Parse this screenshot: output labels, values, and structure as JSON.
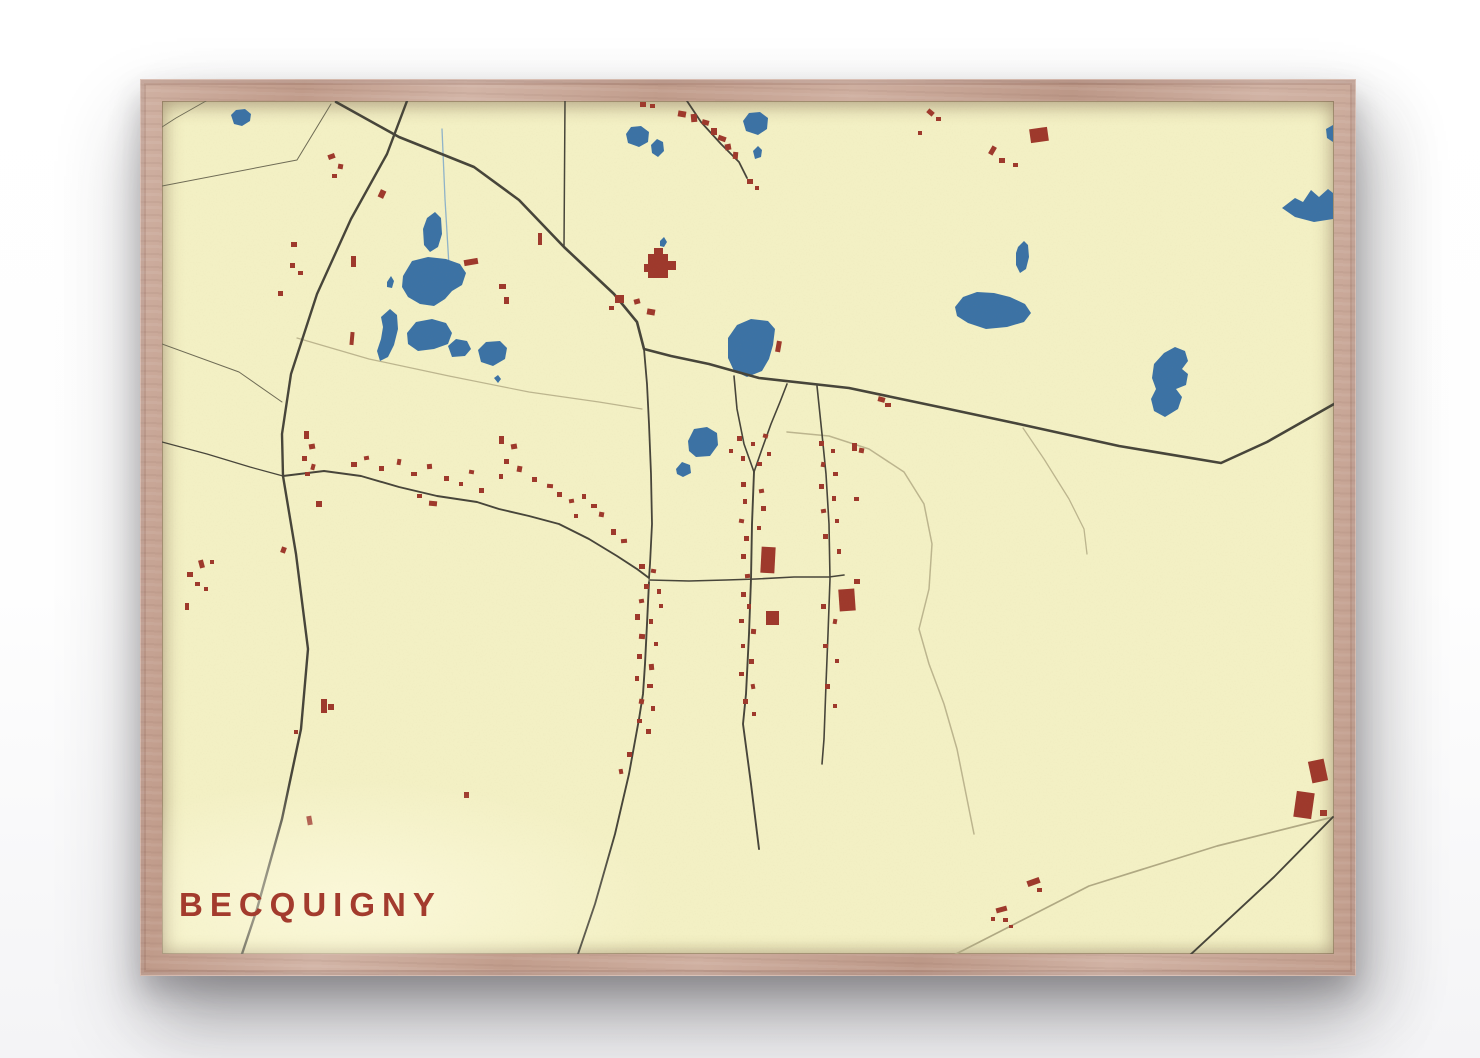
{
  "poster": {
    "title": "BECQUIGNY",
    "title_color": "#a33b2d"
  },
  "frame": {
    "wood_color": "#c8a493"
  },
  "map": {
    "width": 1172,
    "height": 853,
    "colors": {
      "bg": "#f3f0c4",
      "water": "#3c72a4",
      "building": "#9e392c",
      "road": "#47453a",
      "thin": "#6e6b55",
      "trail": "#bcb58e",
      "track": "#b0a983",
      "stream": "#8fb3c9"
    },
    "trails": [
      {
        "n": "village-loop-trail",
        "c": "trail",
        "w": 1.5,
        "p": "625,331 667,335 707,348 742,371 762,403 770,443 767,488 757,528 767,563 782,603 795,648 805,698 812,733"
      },
      {
        "n": "field-track",
        "c": "trail",
        "w": 1.3,
        "p": "861,327 882,358 907,398 922,428 925,453"
      },
      {
        "n": "field-boundary",
        "c": "trail",
        "w": 1.2,
        "p": "135,237 207,258 287,275 367,291 437,301 480,308"
      },
      {
        "n": "southeast-track",
        "c": "track",
        "w": 1.7,
        "p": "1171,716 1055,745 927,785 790,855"
      },
      {
        "n": "stream",
        "c": "stream",
        "w": 1.3,
        "p": "280,28 283,98 287,165"
      }
    ],
    "roads": [
      {
        "n": "highway",
        "c": "road",
        "w": 2.6,
        "p": "174,1 237,36 312,66 357,99 402,146 452,193 475,221 482,248 509,255 547,263 597,277 687,287 782,307 857,323 957,345 1059,362 1105,341 1172,303"
      },
      {
        "n": "west-road",
        "c": "road",
        "w": 2.4,
        "p": "245,0 225,53 189,118 155,193 129,273 120,333 121,375 134,453 146,548 139,628 120,718 95,808 79,856"
      },
      {
        "n": "north-lane",
        "c": "road",
        "w": 1.5,
        "p": "403,0 402,146"
      },
      {
        "n": "farm-lane",
        "c": "road",
        "w": 1.8,
        "p": "525,0 539,21 559,43 577,61 585,77"
      },
      {
        "n": "village-north-street",
        "c": "road",
        "w": 1.8,
        "p": "482,248 485,283 487,323 489,373 490,423 488,463 487,477"
      },
      {
        "n": "main-street",
        "c": "road",
        "w": 1.9,
        "p": "121,375 162,370 199,375 237,386 275,395 315,401 337,408 367,415 397,423 427,438 455,455 475,468 487,477"
      },
      {
        "n": "west-lane",
        "c": "road",
        "w": 1.2,
        "p": "0,341 45,353 88,366 121,375"
      },
      {
        "n": "south-street",
        "c": "road",
        "w": 1.9,
        "p": "487,481 485,523 483,563 481,593 477,618 467,673 453,733 433,803 415,856"
      },
      {
        "n": "cross-street",
        "c": "road",
        "w": 1.6,
        "p": "487,479 527,480 564,479 594,478 632,476 667,476 682,474"
      },
      {
        "n": "east-street",
        "c": "road",
        "w": 1.9,
        "p": "592,371 590,423 589,478 587,533 584,593 581,623 589,683 597,748"
      },
      {
        "n": "fork-west",
        "c": "road",
        "w": 1.6,
        "p": "572,275 575,308 582,343 592,371"
      },
      {
        "n": "fork-east",
        "c": "road",
        "w": 1.6,
        "p": "625,283 618,301 609,323 600,348 592,371"
      },
      {
        "n": "outer-street",
        "c": "road",
        "w": 1.6,
        "p": "655,285 660,333 664,373 667,423 668,478 666,533 664,583 662,638 660,663"
      },
      {
        "n": "southeast-road",
        "c": "road",
        "w": 1.9,
        "p": "1171,716 1112,776 1027,855"
      },
      {
        "n": "boundary-nw",
        "c": "thin",
        "w": 1.0,
        "p": "0,85 135,59 169,3"
      },
      {
        "n": "corner-line",
        "c": "thin",
        "w": 0.9,
        "p": "44,0 14,17 0,26"
      },
      {
        "n": "west-link",
        "c": "thin",
        "w": 1.0,
        "p": "0,243 77,271 120,301"
      }
    ],
    "lakes": [
      "69,14 74,9 83,8 89,13 88,20 80,25 72,23",
      "464,33 469,26 479,25 487,31 486,41 477,46 466,42",
      "489,44 495,38 501,41 502,50 496,56 490,52",
      "581,20 587,12 598,11 606,17 605,28 596,34 584,30",
      "591,50 596,45 600,49 599,56 593,58",
      "856,146 862,140 866,144 867,156 864,168 858,172 854,164 854,152",
      "793,206 801,196 815,191 832,192 848,196 863,203 869,212 862,221 845,226 824,228 806,222 795,215",
      "1120,107 1133,97 1141,101 1149,89 1157,96 1166,88 1171,92 1171,118 1152,121 1133,116",
      "1164,28 1171,24 1171,41 1165,37",
      "1002,252 1013,246 1023,250 1026,260 1020,268 1026,273 1024,284 1014,288 1020,296 1016,308 1003,316 992,310 989,298 994,288 990,277 992,263",
      "566,237 575,224 589,218 606,220 613,228 611,244 607,258 600,270 585,276 572,270 566,257",
      "526,340 532,328 545,326 555,332 556,344 548,355 534,356 527,350",
      "514,368 520,361 528,364 529,372 521,376 515,373",
      "265,117 273,111 279,117 280,133 276,146 268,151 262,144 261,128",
      "241,175 250,160 266,156 284,158 298,163 304,172 300,184 290,190 283,198 272,205 258,203 246,196 240,186",
      "225,181 229,175 232,180 230,187 225,186",
      "219,216 228,208 235,214 236,228 232,244 226,256 218,260 215,250 219,238 221,226",
      "245,232 254,221 270,218 284,222 290,232 286,243 272,248 256,250 246,243",
      "286,245 294,238 305,240 309,248 303,255 290,256",
      "316,249 324,241 338,240 345,247 343,258 331,265 319,261",
      "332,277 336,274 339,278 336,282",
      "498,140 502,136 505,141 502,146 498,145"
    ],
    "buildings": [
      [
        516,
        10,
        8,
        6,
        10
      ],
      [
        529,
        13,
        6,
        8,
        -5
      ],
      [
        540,
        19,
        7,
        5,
        15
      ],
      [
        549,
        27,
        6,
        7,
        0
      ],
      [
        556,
        35,
        8,
        5,
        20
      ],
      [
        563,
        43,
        6,
        6,
        -10
      ],
      [
        571,
        51,
        5,
        7,
        5
      ],
      [
        585,
        78,
        6,
        5,
        0
      ],
      [
        593,
        85,
        4,
        4,
        0
      ],
      [
        478,
        1,
        6,
        5,
        0
      ],
      [
        488,
        3,
        5,
        4,
        0
      ],
      [
        765,
        9,
        7,
        5,
        40
      ],
      [
        774,
        16,
        5,
        4,
        0
      ],
      [
        756,
        30,
        4,
        4,
        0
      ],
      [
        868,
        27,
        18,
        14,
        -8
      ],
      [
        828,
        45,
        5,
        9,
        30
      ],
      [
        837,
        57,
        6,
        5,
        0
      ],
      [
        851,
        62,
        5,
        4,
        0
      ],
      [
        486,
        153,
        20,
        24,
        0
      ],
      [
        492,
        147,
        9,
        7,
        0
      ],
      [
        505,
        160,
        9,
        9,
        0
      ],
      [
        482,
        163,
        5,
        8,
        0
      ],
      [
        453,
        194,
        9,
        8,
        0
      ],
      [
        447,
        205,
        5,
        4,
        0
      ],
      [
        472,
        198,
        6,
        5,
        -15
      ],
      [
        485,
        208,
        8,
        6,
        10
      ],
      [
        376,
        132,
        4,
        12,
        0
      ],
      [
        166,
        53,
        7,
        5,
        -20
      ],
      [
        176,
        63,
        5,
        5,
        10
      ],
      [
        170,
        73,
        5,
        4,
        0
      ],
      [
        217,
        89,
        6,
        8,
        25
      ],
      [
        129,
        141,
        6,
        5,
        0
      ],
      [
        128,
        162,
        5,
        5,
        0
      ],
      [
        136,
        170,
        5,
        4,
        0
      ],
      [
        116,
        190,
        5,
        5,
        0
      ],
      [
        302,
        158,
        14,
        6,
        -10
      ],
      [
        337,
        183,
        7,
        5,
        0
      ],
      [
        342,
        196,
        5,
        7,
        0
      ],
      [
        189,
        155,
        5,
        11,
        0
      ],
      [
        188,
        231,
        4,
        13,
        5
      ],
      [
        25,
        471,
        6,
        5,
        0
      ],
      [
        33,
        481,
        5,
        4,
        0
      ],
      [
        37,
        459,
        5,
        8,
        -15
      ],
      [
        42,
        486,
        4,
        4,
        0
      ],
      [
        23,
        502,
        4,
        7,
        0
      ],
      [
        48,
        459,
        4,
        4,
        0
      ],
      [
        119,
        446,
        5,
        6,
        20
      ],
      [
        154,
        400,
        6,
        6,
        0
      ],
      [
        142,
        330,
        5,
        8,
        0
      ],
      [
        147,
        343,
        6,
        5,
        -10
      ],
      [
        140,
        355,
        5,
        5,
        0
      ],
      [
        149,
        363,
        4,
        6,
        15
      ],
      [
        143,
        371,
        5,
        4,
        0
      ],
      [
        189,
        361,
        6,
        5,
        0
      ],
      [
        202,
        355,
        5,
        4,
        -10
      ],
      [
        217,
        365,
        5,
        5,
        0
      ],
      [
        235,
        358,
        4,
        6,
        10
      ],
      [
        249,
        371,
        6,
        4,
        0
      ],
      [
        265,
        363,
        5,
        5,
        -5
      ],
      [
        282,
        375,
        5,
        5,
        0
      ],
      [
        297,
        381,
        4,
        4,
        0
      ],
      [
        307,
        369,
        5,
        4,
        10
      ],
      [
        317,
        387,
        5,
        5,
        0
      ],
      [
        267,
        400,
        8,
        5,
        5
      ],
      [
        255,
        393,
        5,
        4,
        0
      ],
      [
        337,
        335,
        5,
        8,
        0
      ],
      [
        349,
        343,
        6,
        5,
        -10
      ],
      [
        342,
        358,
        5,
        5,
        0
      ],
      [
        355,
        365,
        5,
        6,
        10
      ],
      [
        337,
        373,
        4,
        5,
        0
      ],
      [
        370,
        376,
        5,
        5,
        0
      ],
      [
        385,
        383,
        6,
        4,
        5
      ],
      [
        395,
        391,
        5,
        5,
        0
      ],
      [
        407,
        398,
        5,
        4,
        -10
      ],
      [
        420,
        393,
        4,
        5,
        0
      ],
      [
        429,
        403,
        6,
        4,
        0
      ],
      [
        437,
        411,
        5,
        5,
        10
      ],
      [
        412,
        413,
        4,
        4,
        0
      ],
      [
        449,
        428,
        5,
        6,
        0
      ],
      [
        459,
        438,
        6,
        4,
        -5
      ],
      [
        477,
        463,
        6,
        5,
        0
      ],
      [
        489,
        468,
        5,
        4,
        10
      ],
      [
        482,
        483,
        5,
        5,
        0
      ],
      [
        495,
        488,
        4,
        5,
        0
      ],
      [
        477,
        498,
        5,
        4,
        -10
      ],
      [
        497,
        503,
        4,
        4,
        0
      ],
      [
        473,
        513,
        5,
        6,
        0
      ],
      [
        487,
        518,
        4,
        5,
        0
      ],
      [
        477,
        533,
        6,
        5,
        5
      ],
      [
        492,
        541,
        4,
        4,
        0
      ],
      [
        475,
        553,
        5,
        5,
        0
      ],
      [
        487,
        563,
        5,
        6,
        -5
      ],
      [
        473,
        575,
        4,
        5,
        0
      ],
      [
        485,
        583,
        6,
        4,
        0
      ],
      [
        477,
        598,
        5,
        5,
        10
      ],
      [
        489,
        605,
        4,
        5,
        0
      ],
      [
        475,
        618,
        5,
        4,
        0
      ],
      [
        484,
        628,
        5,
        5,
        0
      ],
      [
        465,
        651,
        5,
        5,
        0
      ],
      [
        457,
        668,
        4,
        5,
        -10
      ],
      [
        302,
        691,
        5,
        6,
        0
      ],
      [
        575,
        335,
        5,
        5,
        0
      ],
      [
        589,
        341,
        4,
        4,
        0
      ],
      [
        601,
        333,
        5,
        4,
        15
      ],
      [
        579,
        355,
        4,
        5,
        0
      ],
      [
        595,
        361,
        5,
        4,
        0
      ],
      [
        605,
        351,
        4,
        4,
        0
      ],
      [
        567,
        348,
        4,
        4,
        0
      ],
      [
        614,
        240,
        5,
        11,
        10
      ],
      [
        579,
        381,
        5,
        5,
        0
      ],
      [
        597,
        388,
        5,
        4,
        -10
      ],
      [
        581,
        398,
        4,
        5,
        0
      ],
      [
        599,
        405,
        5,
        5,
        0
      ],
      [
        577,
        418,
        5,
        4,
        10
      ],
      [
        595,
        425,
        4,
        4,
        0
      ],
      [
        582,
        435,
        5,
        5,
        0
      ],
      [
        579,
        453,
        5,
        5,
        0
      ],
      [
        583,
        473,
        5,
        4,
        -5
      ],
      [
        579,
        491,
        5,
        5,
        0
      ],
      [
        585,
        503,
        4,
        5,
        0
      ],
      [
        577,
        518,
        5,
        4,
        0
      ],
      [
        589,
        528,
        5,
        5,
        5
      ],
      [
        579,
        543,
        4,
        4,
        0
      ],
      [
        587,
        558,
        5,
        5,
        0
      ],
      [
        577,
        571,
        5,
        4,
        0
      ],
      [
        589,
        583,
        4,
        5,
        -10
      ],
      [
        581,
        598,
        5,
        5,
        0
      ],
      [
        590,
        611,
        4,
        4,
        0
      ],
      [
        599,
        446,
        14,
        26,
        3
      ],
      [
        604,
        510,
        13,
        14,
        0
      ],
      [
        657,
        340,
        5,
        5,
        0
      ],
      [
        669,
        348,
        4,
        4,
        0
      ],
      [
        659,
        361,
        4,
        5,
        10
      ],
      [
        671,
        371,
        5,
        4,
        0
      ],
      [
        657,
        383,
        5,
        5,
        0
      ],
      [
        670,
        395,
        4,
        5,
        0
      ],
      [
        659,
        408,
        5,
        4,
        -10
      ],
      [
        673,
        418,
        4,
        4,
        0
      ],
      [
        661,
        433,
        5,
        5,
        0
      ],
      [
        675,
        448,
        4,
        5,
        0
      ],
      [
        692,
        478,
        6,
        5,
        0
      ],
      [
        677,
        488,
        16,
        22,
        -4
      ],
      [
        659,
        503,
        5,
        5,
        0
      ],
      [
        671,
        518,
        4,
        5,
        10
      ],
      [
        661,
        543,
        5,
        4,
        0
      ],
      [
        673,
        558,
        4,
        4,
        0
      ],
      [
        663,
        583,
        5,
        5,
        0
      ],
      [
        671,
        603,
        4,
        4,
        0
      ],
      [
        716,
        296,
        7,
        5,
        15
      ],
      [
        723,
        302,
        6,
        4,
        0
      ],
      [
        690,
        342,
        5,
        8,
        0
      ],
      [
        697,
        347,
        5,
        5,
        10
      ],
      [
        692,
        396,
        5,
        4,
        0
      ],
      [
        1133,
        691,
        18,
        26,
        8
      ],
      [
        1148,
        659,
        16,
        22,
        -12
      ],
      [
        1158,
        709,
        7,
        6,
        0
      ],
      [
        865,
        778,
        13,
        6,
        -20
      ],
      [
        875,
        787,
        5,
        4,
        0
      ],
      [
        834,
        806,
        11,
        5,
        -15
      ],
      [
        829,
        816,
        4,
        4,
        0
      ],
      [
        841,
        817,
        5,
        4,
        0
      ],
      [
        847,
        824,
        4,
        3,
        0
      ],
      [
        159,
        598,
        6,
        14,
        0
      ],
      [
        166,
        603,
        6,
        6,
        0
      ],
      [
        145,
        715,
        5,
        9,
        -10
      ],
      [
        132,
        629,
        4,
        4,
        0
      ]
    ]
  }
}
